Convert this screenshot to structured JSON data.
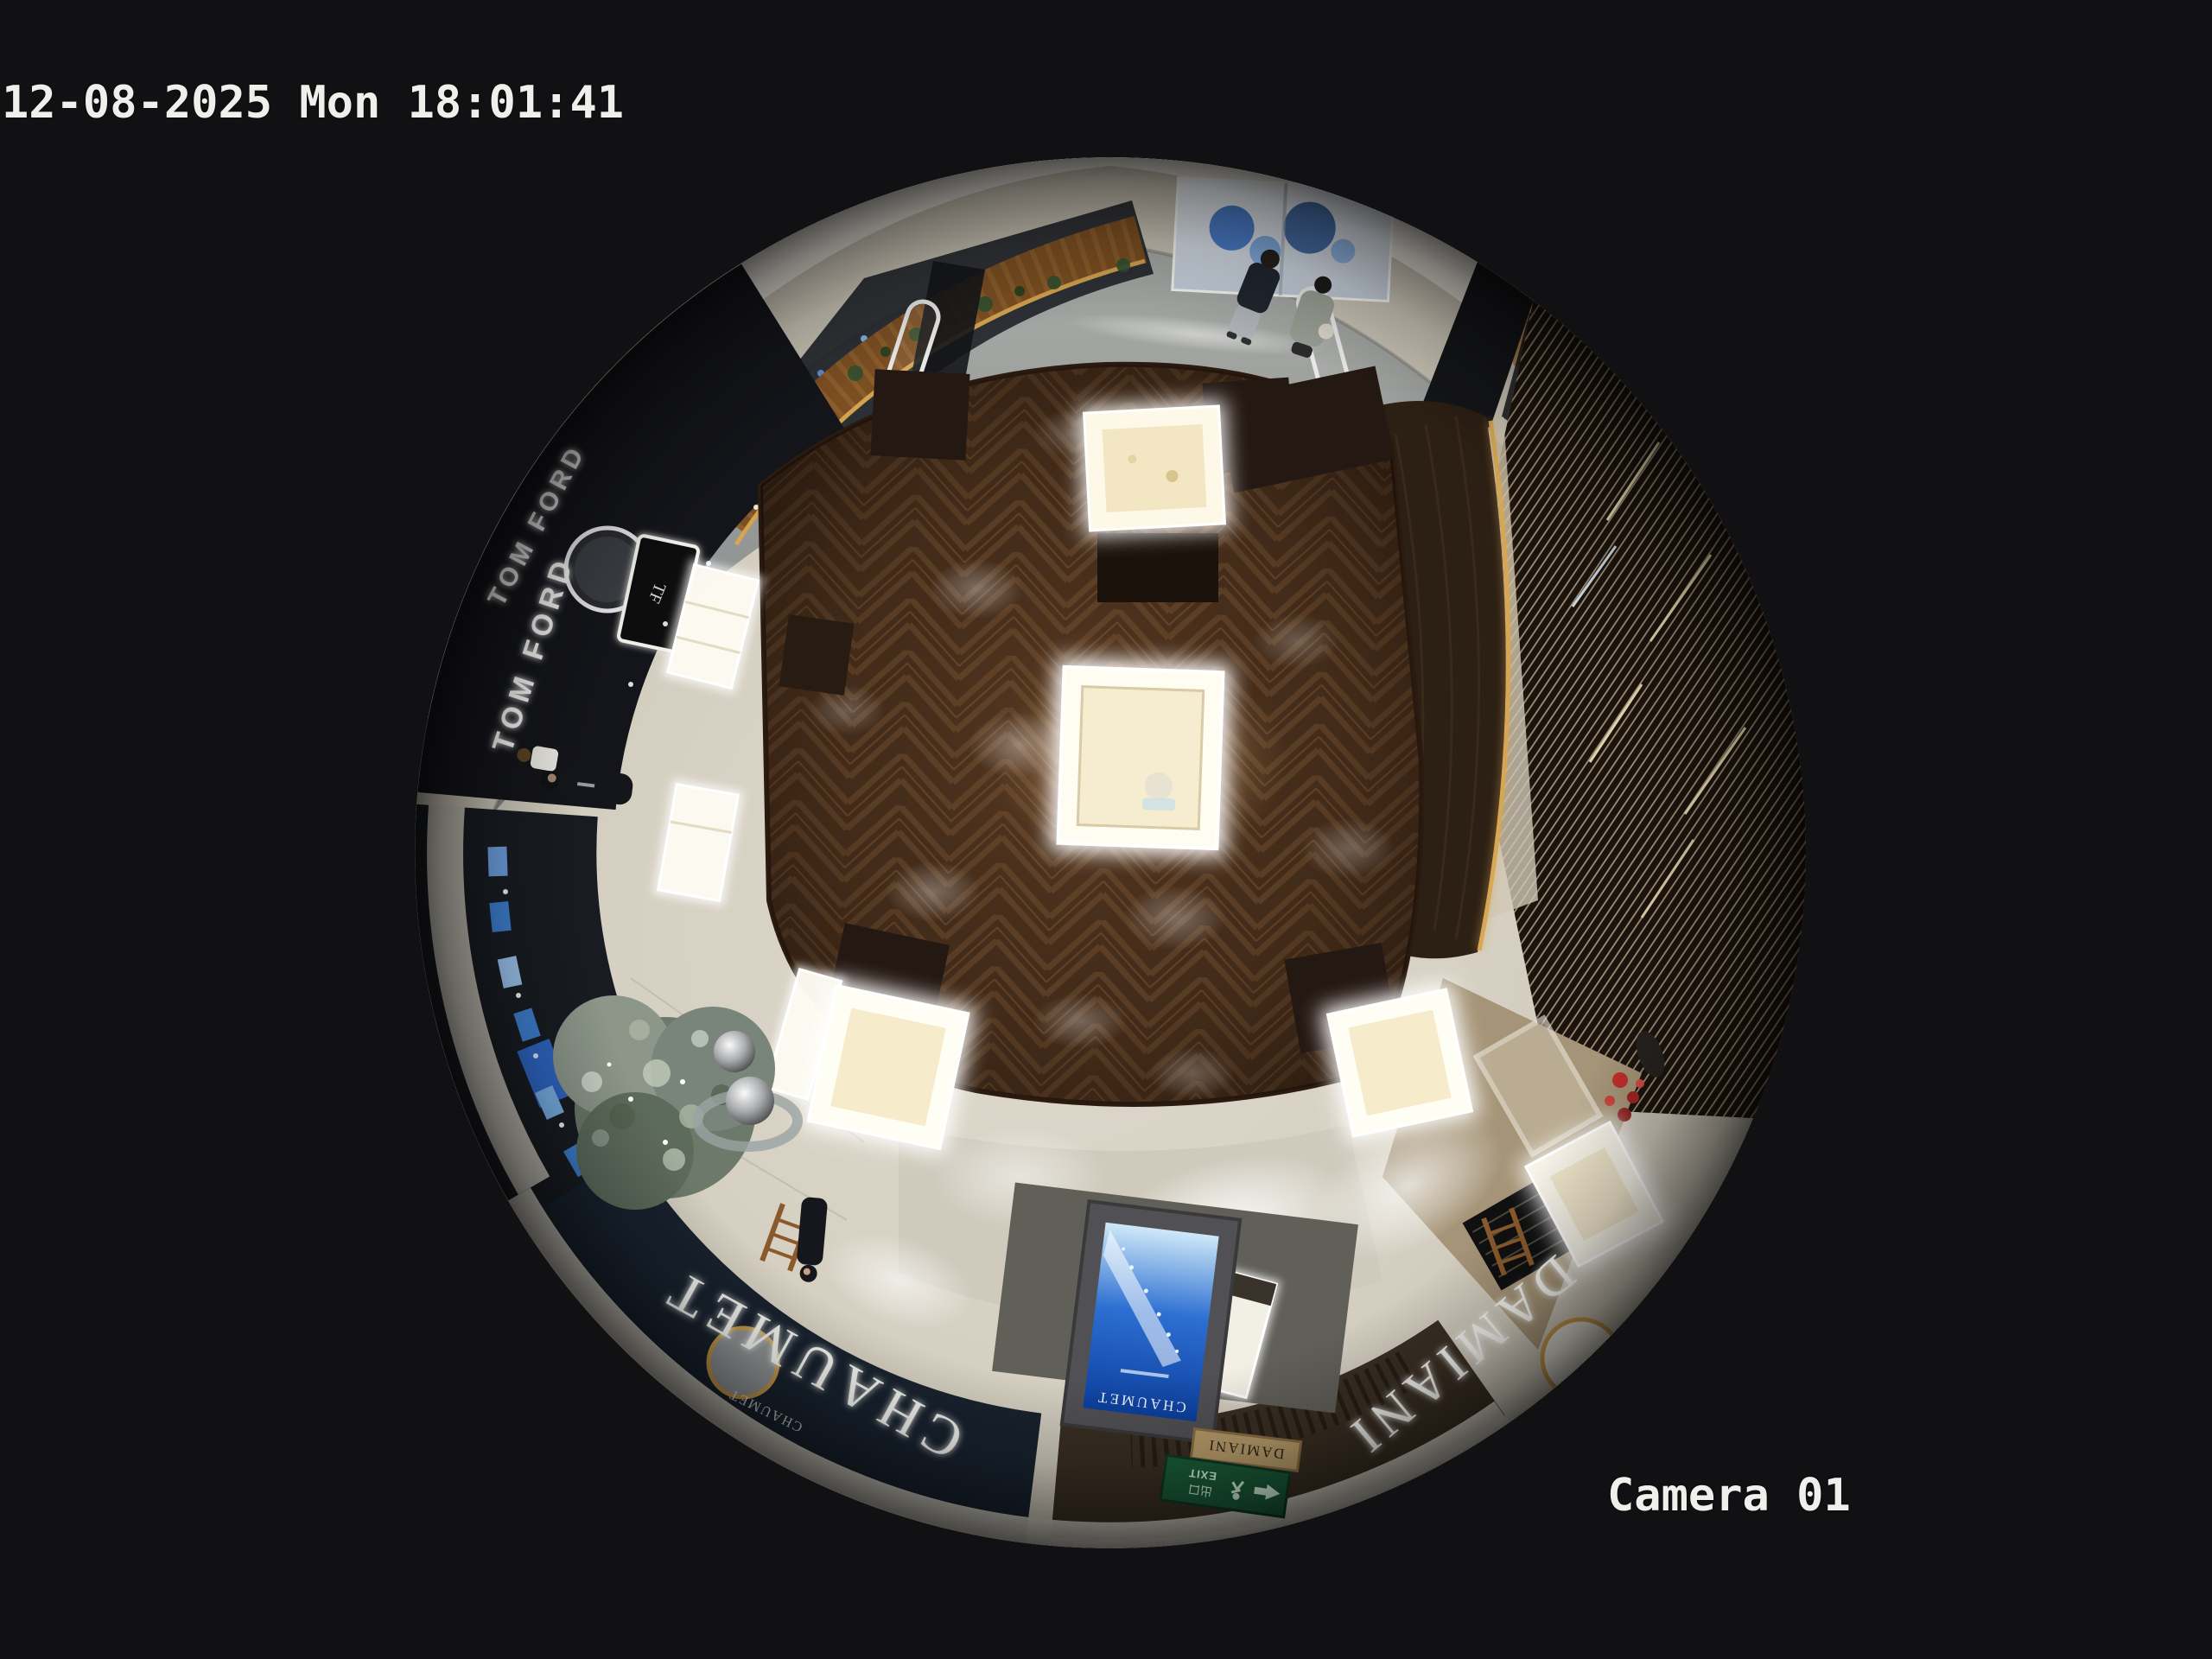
{
  "osd": {
    "timestamp": "12-08-2025 Mon 18:01:41",
    "camera_label": "Camera 01"
  },
  "fisheye": {
    "signs": {
      "tom_ford_upper": "TOM FORD",
      "tom_ford_lower": "TOM FORD",
      "tf_monogram": "TF",
      "chaumet_fascia": "CHAUMET",
      "chaumet_fascia_small": "CHAUMET",
      "chaumet_screen": "CHAUMET",
      "damiani_fascia": "DAMIANI",
      "damiani_plaque": "DAMIANI",
      "exit_en": "EXIT",
      "exit_cn": "出口"
    },
    "colors": {
      "background": "#111113",
      "osd_text": "#efefeb",
      "marble_floor": "#d6d0c2",
      "corridor_floor": "#9a9e9e",
      "ceiling_band": "#e9e6dd",
      "wood_floor": "#442d1b",
      "tom_ford_fascia": "#14151a",
      "chaumet_fascia": "#18222e",
      "damiani_fascia": "#3a2f23",
      "louver_wall": "#1c130c",
      "amber_led": "#d8a752",
      "exit_green": "#1a5c38",
      "screen_blue": "#2d6fd2",
      "case_glow": "#fffdf2"
    }
  }
}
